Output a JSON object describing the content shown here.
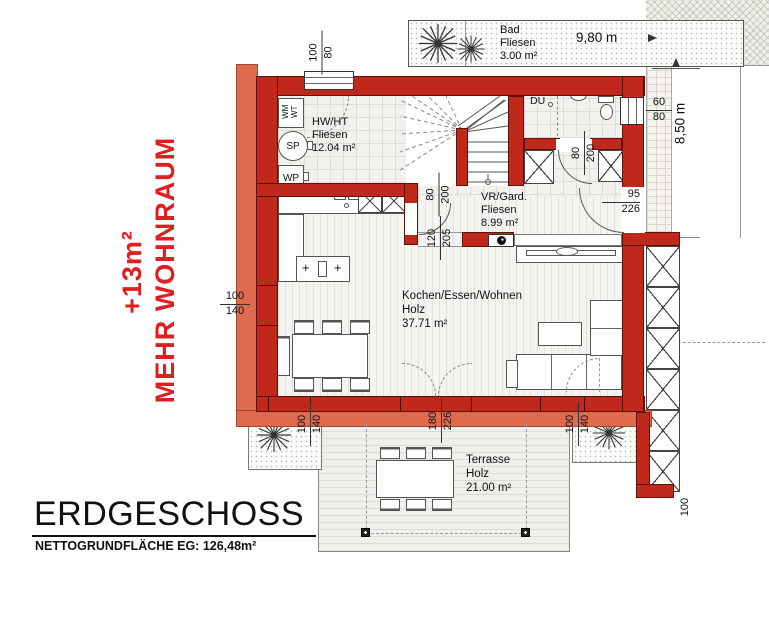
{
  "colors": {
    "wall": "#c0281c",
    "insulation": "#e06a4e",
    "promo": "#e01e20"
  },
  "promo": {
    "gain": "+13m²",
    "text": "MEHR WOHNRAUM"
  },
  "title": {
    "heading": "ERDGESCHOSS",
    "subheading": "NETTOGRUNDFLÄCHE EG: 126,48m²"
  },
  "rooms": {
    "bad": {
      "name": "Bad",
      "floor": "Fliesen",
      "area": "3.00 m²"
    },
    "hwht": {
      "name": "HW/HT",
      "floor": "Fliesen",
      "area": "12.04 m²"
    },
    "vr": {
      "name": "VR/Gard.",
      "floor": "Fliesen",
      "area": "8.99 m²"
    },
    "wohnen": {
      "name": "Kochen/Essen/Wohnen",
      "floor": "Holz",
      "area": "37.71 m²"
    },
    "terrasse": {
      "name": "Terrasse",
      "floor": "Holz",
      "area": "21.00 m²"
    }
  },
  "fixtures": {
    "du": "DU",
    "wm": "WM",
    "wt": "WT",
    "sp": "SP",
    "wp": "WP",
    "cooktop_mark": "+"
  },
  "dimensions": {
    "overall_width": "9,80 m",
    "overall_height": "8,50 m",
    "top_window": {
      "w": "100",
      "h": "80"
    },
    "bath_window": {
      "w": "60",
      "h": "80"
    },
    "bath_door": {
      "w": "80",
      "h": "200"
    },
    "hall_door": {
      "w": "80",
      "h": "200"
    },
    "kitchen_pass": {
      "w": "120",
      "h": "205"
    },
    "entry_door": {
      "w": "95",
      "h": "226"
    },
    "left_window": {
      "w": "100",
      "h": "140"
    },
    "terrace_door": {
      "w": "180",
      "h": "226"
    },
    "bottom_left_window": {
      "w": "100",
      "h": "140"
    },
    "bottom_right_window": {
      "w": "100",
      "h": "140"
    },
    "pergola": "100"
  }
}
